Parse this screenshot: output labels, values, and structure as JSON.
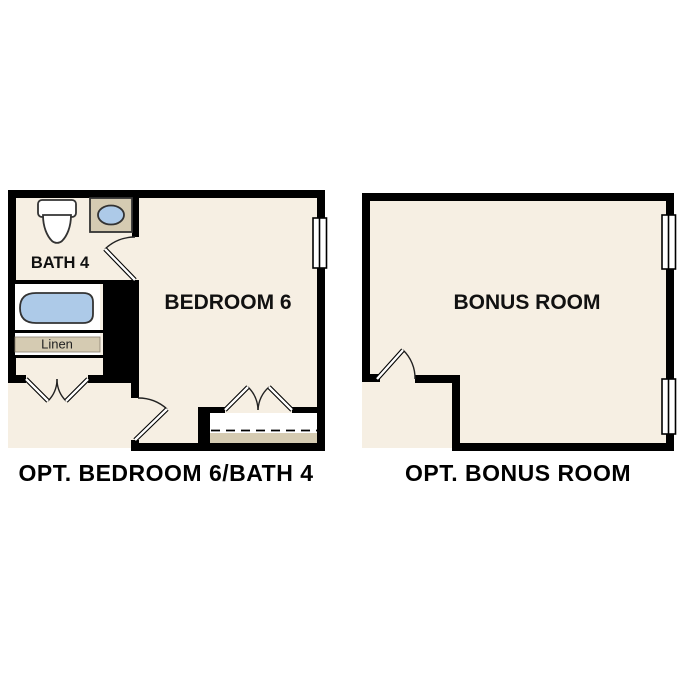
{
  "colors": {
    "floor": "#F6EFE3",
    "wall": "#000000",
    "tan": "#D5CBB2",
    "blue": "#ADCAE8",
    "white": "#FFFFFF"
  },
  "left_plan": {
    "caption": "OPT. BEDROOM 6/BATH 4",
    "labels": {
      "bath": "BATH 4",
      "bedroom": "BEDROOM 6",
      "linen": "Linen"
    },
    "fixtures": [
      "toilet",
      "sink-vanity",
      "bathtub",
      "linen-shelf",
      "closet-shelf-rod"
    ],
    "window_count": 1,
    "door_count": 4
  },
  "right_plan": {
    "caption": "OPT. BONUS ROOM",
    "labels": {
      "room": "BONUS ROOM"
    },
    "fixtures": [],
    "window_count": 2,
    "door_count": 1
  }
}
